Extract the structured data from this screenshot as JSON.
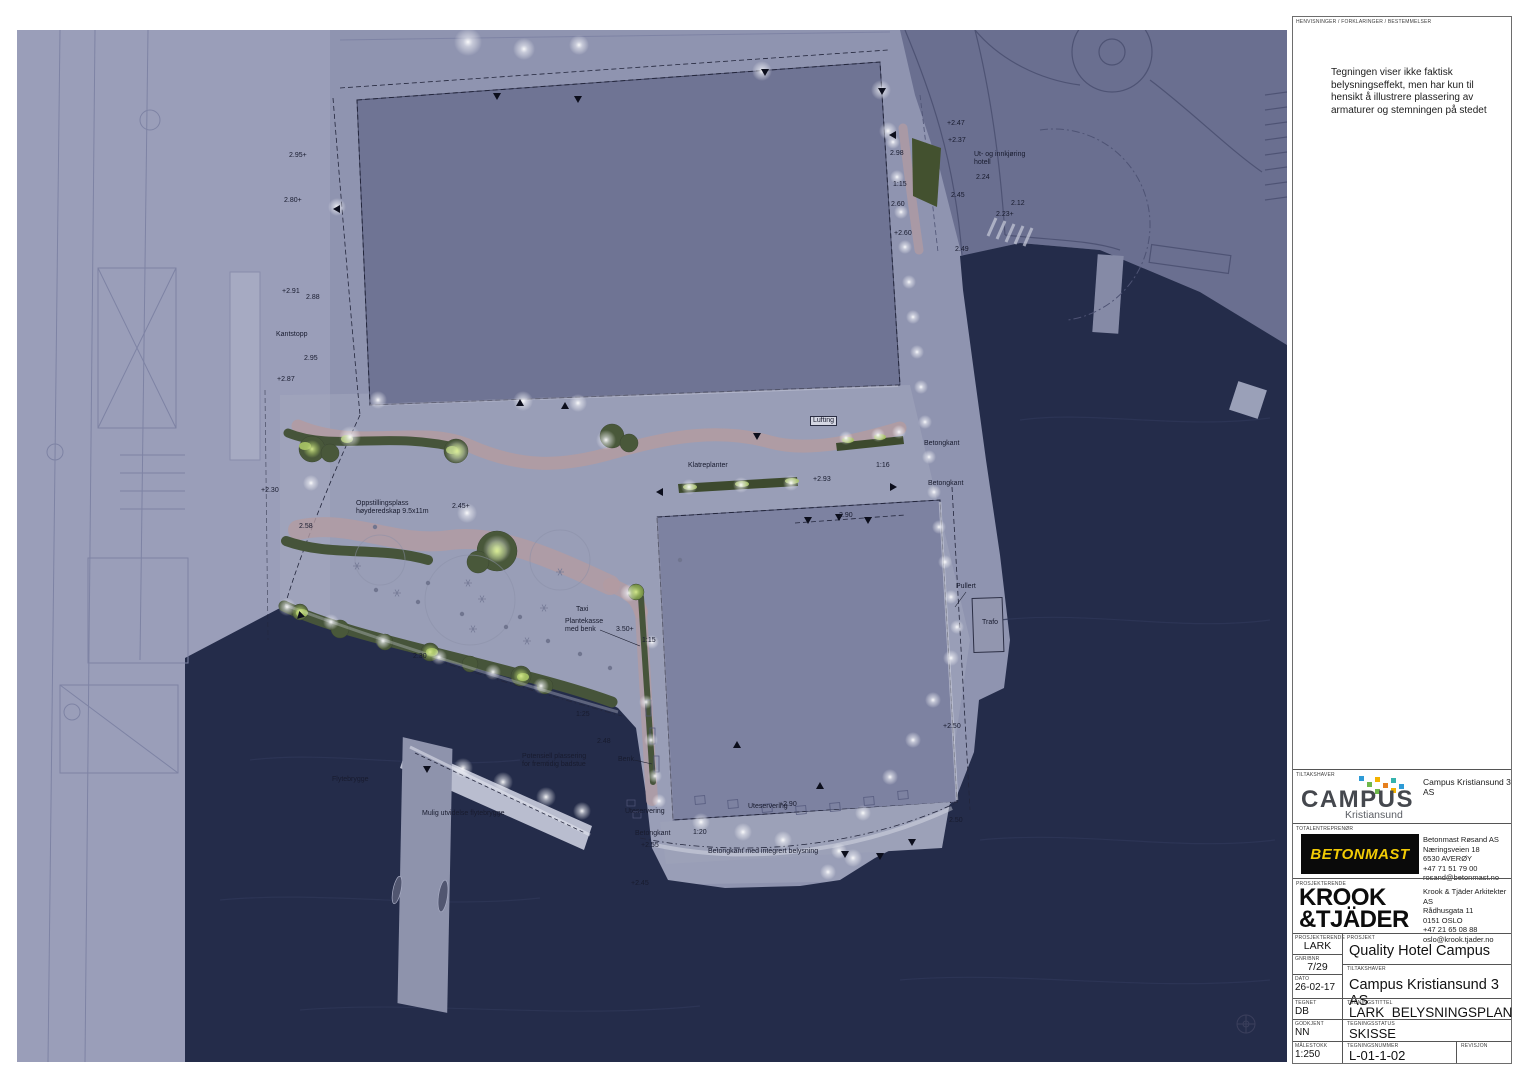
{
  "margin": {
    "header_label": "HENVISNINGER / FORKLARINGER / BESTEMMELSER",
    "note": "Tegningen viser ikke faktisk\nbelysningseffekt, men har kun til\nhensikt å illustrere plassering av\narmaturer og stemningen på stedet"
  },
  "title_block": {
    "tiltakshaver": {
      "label": "TILTAKSHAVER",
      "value": "Campus Kristiansund 3 AS",
      "logo_word": "CAMPUS",
      "logo_sub": "Kristiansund"
    },
    "totalentreprenor": {
      "label": "TOTALENTREPRENØR",
      "logo_word": "BETONMAST",
      "address": [
        "Betonmast Røsand AS",
        "Næringsveien 18",
        "6530 AVERØY",
        "+47 71 51 79 00",
        "rosand@betonmast.no"
      ]
    },
    "prosjekterende_firm": {
      "label": "PROSJEKTERENDE",
      "logo_line1": "KROOK",
      "logo_line2": "&TJÄDER",
      "address": [
        "Krook & Tjäder Arkitekter AS",
        "Rådhusgata 11",
        "0151 OSLO",
        "+47 21 65 08 88",
        "oslo@krook.tjader.no"
      ]
    },
    "fields": {
      "prosjekterende": {
        "label": "PROSJEKTERENDE",
        "value": "LARK"
      },
      "gnr_bnr": {
        "label": "GNR/BNR",
        "value": "7/29"
      },
      "dato": {
        "label": "DATO",
        "value": "26-02-17"
      },
      "tegnet": {
        "label": "TEGNET",
        "value": "DB"
      },
      "godkjent": {
        "label": "GODKJENT",
        "value": "NN"
      },
      "malestokk": {
        "label": "MÅLESTOKK",
        "value": "1:250"
      },
      "prosjekt": {
        "label": "PROSJEKT",
        "value": "Quality Hotel Campus"
      },
      "tiltakshaver": {
        "label": "TILTAKSHAVER",
        "value": "Campus Kristiansund 3 AS"
      },
      "tegningstittel": {
        "label": "TEGNINGSTITTEL",
        "value": "LARK_BELYSNINGSPLAN"
      },
      "tegningsstatus": {
        "label": "TEGNINGSSTATUS",
        "value": "SKISSE"
      },
      "tegningsnummer": {
        "label": "TEGNINGSNUMMER",
        "value": "L-01-1-02"
      },
      "revisjon": {
        "label": "REVISJON",
        "value": ""
      }
    }
  },
  "colors": {
    "water": "#242c4a",
    "land": "#8f94b0",
    "land_left": "#9a9eb9",
    "land_dark": "#6a6f90",
    "plaza": "#a3a7be",
    "building_top": "#6f7494",
    "building_lower": "#7d82a1",
    "path_pink": "#b39ba1",
    "planting_green": "#46543a",
    "lit_green": "#a9c566",
    "glow_white": "#ffffff",
    "betonmast_yellow": "#f2cb05",
    "campus_squares": [
      "#2e9bd6",
      "#6fb84a",
      "#f3b200",
      "#e6801f",
      "#35b3ad"
    ]
  },
  "plan": {
    "labels": [
      {
        "text": "Kantstopp",
        "x": 276,
        "y": 331
      },
      {
        "text": "+2.87",
        "x": 277,
        "y": 376
      },
      {
        "text": "2.95+",
        "x": 289,
        "y": 152
      },
      {
        "text": "2.80+",
        "x": 284,
        "y": 197
      },
      {
        "text": "+2.91",
        "x": 282,
        "y": 288
      },
      {
        "text": "2.88",
        "x": 306,
        "y": 294
      },
      {
        "text": "2.95",
        "x": 304,
        "y": 355
      },
      {
        "text": "+2.47",
        "x": 947,
        "y": 120
      },
      {
        "text": "+2.37",
        "x": 948,
        "y": 137
      },
      {
        "text": "Ut- og innkjøring\nhotell",
        "x": 974,
        "y": 151
      },
      {
        "text": "2.24",
        "x": 976,
        "y": 174
      },
      {
        "text": "2.45",
        "x": 951,
        "y": 192
      },
      {
        "text": "2.12",
        "x": 1011,
        "y": 200
      },
      {
        "text": "2.23+",
        "x": 996,
        "y": 211
      },
      {
        "text": "2.49",
        "x": 955,
        "y": 246
      },
      {
        "text": "2.98",
        "x": 890,
        "y": 150
      },
      {
        "text": "1:15",
        "x": 893,
        "y": 181
      },
      {
        "text": "2.60",
        "x": 891,
        "y": 201
      },
      {
        "text": "+2.60",
        "x": 894,
        "y": 230
      },
      {
        "text": "Oppstillingsplass\nhøyderedskap 9.5x11m",
        "x": 356,
        "y": 500
      },
      {
        "text": "2.45+",
        "x": 452,
        "y": 503
      },
      {
        "text": "Klatreplanter",
        "x": 688,
        "y": 462
      },
      {
        "text": "Lufting",
        "x": 810,
        "y": 416
      },
      {
        "text": "Betongkant",
        "x": 924,
        "y": 440
      },
      {
        "text": "Betongkant",
        "x": 928,
        "y": 480
      },
      {
        "text": "1:16",
        "x": 876,
        "y": 462
      },
      {
        "text": "+2.93",
        "x": 813,
        "y": 476
      },
      {
        "text": "2.90",
        "x": 839,
        "y": 512
      },
      {
        "text": "Pullert",
        "x": 956,
        "y": 583
      },
      {
        "text": "Trafo",
        "x": 982,
        "y": 619
      },
      {
        "text": "Taxi",
        "x": 576,
        "y": 606
      },
      {
        "text": "Plantekasse\nmed benk",
        "x": 565,
        "y": 618
      },
      {
        "text": "3.50+",
        "x": 616,
        "y": 626
      },
      {
        "text": "1:15",
        "x": 642,
        "y": 637
      },
      {
        "text": "Benk",
        "x": 618,
        "y": 756
      },
      {
        "text": "Uteservering",
        "x": 625,
        "y": 808
      },
      {
        "text": "Uteservering",
        "x": 748,
        "y": 803
      },
      {
        "text": "+2.90",
        "x": 779,
        "y": 801
      },
      {
        "text": "Betongkant",
        "x": 635,
        "y": 830
      },
      {
        "text": "1:20",
        "x": 693,
        "y": 829
      },
      {
        "text": "+2.55",
        "x": 641,
        "y": 842
      },
      {
        "text": "Betongkant med integrert belysning",
        "x": 708,
        "y": 848
      },
      {
        "text": "+2.45",
        "x": 631,
        "y": 880
      },
      {
        "text": "Flytebrygge",
        "x": 332,
        "y": 776
      },
      {
        "text": "Mulig utvidelse flytebrygge",
        "x": 422,
        "y": 810
      },
      {
        "text": "Potensiell plassering\nfor fremtidig badstue",
        "x": 522,
        "y": 753
      },
      {
        "text": "1:25",
        "x": 576,
        "y": 711
      },
      {
        "text": "+2.50",
        "x": 943,
        "y": 723
      },
      {
        "text": "2.50",
        "x": 949,
        "y": 817
      },
      {
        "text": "2.30",
        "x": 413,
        "y": 653
      },
      {
        "text": "2.48",
        "x": 597,
        "y": 738
      },
      {
        "text": "+2.30",
        "x": 261,
        "y": 487
      },
      {
        "text": "2.58",
        "x": 299,
        "y": 523
      }
    ]
  }
}
